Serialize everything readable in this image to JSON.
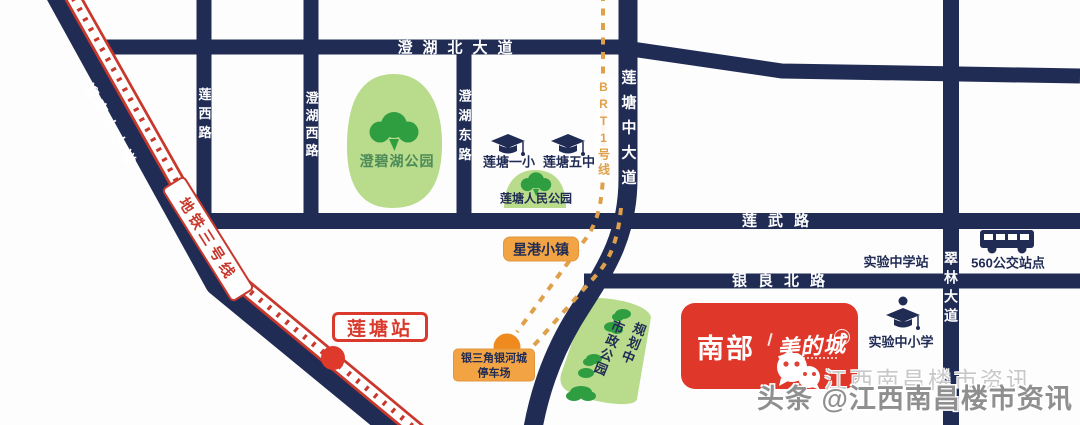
{
  "map": {
    "roads": {
      "chenghu_north": "澄湖北大道",
      "lianwu": "莲武路",
      "yinliang_north": "银良北路",
      "lianxi": "莲西路",
      "chenghu_west": "澄湖西路",
      "chenghu_east": "澄湖东路",
      "liantang_middle": "莲塘中大道",
      "cuilin": "翠林大道",
      "yingbin_middle": "迎宾中大道"
    },
    "transit": {
      "metro_line_3": "地铁三号线",
      "liantang_station": "莲塘站",
      "brt_line_1": "BRT1号线",
      "parking_line1": "银三角银河城",
      "parking_line2": "停车场",
      "bus_stop_560": "560公交站点",
      "experimental_school_station": "实验中学站"
    },
    "parks": {
      "chengbi_lake": "澄碧湖公园",
      "liantang_renmin": "莲塘人民公园",
      "municipal": "市政公园",
      "municipal_status": "规划中"
    },
    "schools": {
      "liantang_no1_primary": "莲塘一小",
      "liantang_no5_middle": "莲塘五中",
      "experimental_primary_middle": "实验中小学"
    },
    "places": {
      "xinggang_town": "星港小镇",
      "brand_name_cn": "南部",
      "brand_sub_cn": "美的城"
    },
    "watermarks": {
      "wechat_line": "江西南昌楼市资讯",
      "toutiao_line": "头条 @江西南昌楼市资讯"
    },
    "colors": {
      "road_navy": "#212c55",
      "metro_red": "#c9382c",
      "brand_red": "#df382b",
      "brt_orange": "#dfa049",
      "marker_orange": "#ee8a1e",
      "box_orange": "#f2a444",
      "park_green": "#b8db8c",
      "tree_green": "#2f9e41"
    },
    "icons": [
      "tree-icon",
      "bush-icon",
      "graduation-cap-icon",
      "bus-icon",
      "wechat-icon",
      "metro-station-dot",
      "brt-terminal-dot"
    ]
  }
}
